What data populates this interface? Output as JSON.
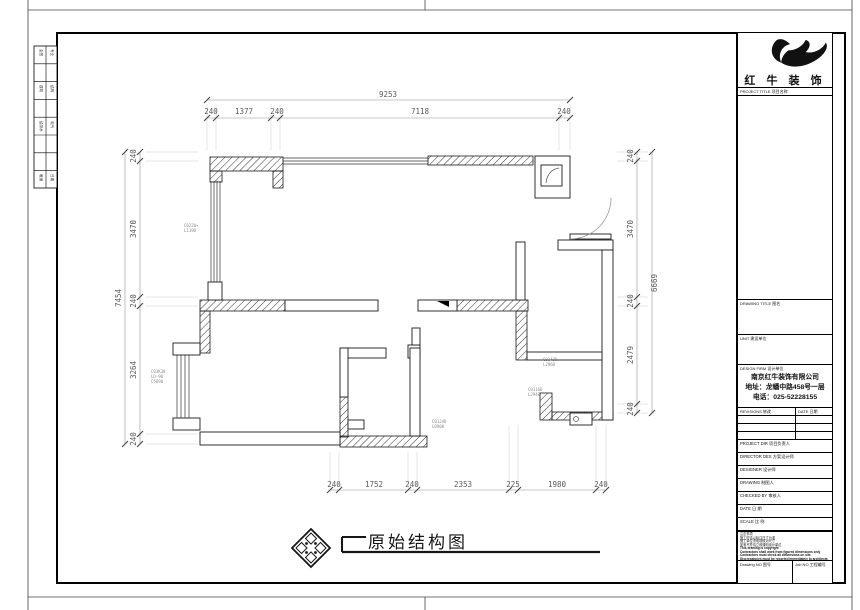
{
  "sheet": {
    "bottom_title": "原始结构图",
    "brand": "红 牛 装 饰"
  },
  "strip": {
    "cells": [
      "会签",
      "专业",
      "建筑",
      "结构",
      "给排水",
      "电气",
      "暖通",
      "日期"
    ]
  },
  "dims": {
    "top": {
      "total": "9253",
      "segs": [
        "240",
        "1377",
        "240",
        "7118",
        "240"
      ]
    },
    "left": {
      "total": "7454",
      "segs": [
        "240",
        "3470",
        "240",
        "3264",
        "240"
      ]
    },
    "right": {
      "total": "6669",
      "segs": [
        "240",
        "3470",
        "240",
        "2479",
        "240"
      ]
    },
    "bottom": {
      "segs": [
        "240",
        "1752",
        "240",
        "2353",
        "225",
        "1980",
        "240"
      ]
    }
  },
  "ann": {
    "a1": "C0220+",
    "a2": "L1190",
    "b1": "C03K30",
    "b2": "LD-90",
    "b3": "C5690",
    "c1": "C0143D",
    "c2": "L2960",
    "d1": "C0116D",
    "d2": "L2940",
    "e1": "C0124D",
    "e2": "L0900"
  },
  "titleblock": {
    "project_title_label": "PROJECT TITLE 项目名称",
    "drawing_title_label": "DRAWING TITLE 图名",
    "unit_label": "UNIT 建设单位",
    "design_firm_label": "DESIGN FIRM 设计单位",
    "company": [
      "南京红牛装饰有限公司",
      "地址：龙蟠中路458号一层",
      "电话：025-52228155"
    ],
    "revisions_label": "REVISIONS 修改",
    "date_col_label": "DATE 日期",
    "row_labels": [
      "PROJECT DIR 项目负责人",
      "DIRECTOR DES 方案设计师",
      "DESIGNER 设计师",
      "DRAWING 制图人",
      "CHECKED BY 审核人",
      "DATE 日 期",
      "SCALE 比 例"
    ],
    "notes": [
      "注意事项",
      "施工时请以标注尺寸为准",
      "施工单位须现场核对尺寸",
      "如有不符请立即通知设计单位",
      "This drawing is copyright",
      "Contractors shall work from figured dimensions only",
      "Contractors must check all dimensions on site",
      "Discrepancies must be reported immediately to architects"
    ],
    "drawing_no_label": "Drawing NO 图号",
    "job_no_label": "Job NO 工程编号"
  }
}
